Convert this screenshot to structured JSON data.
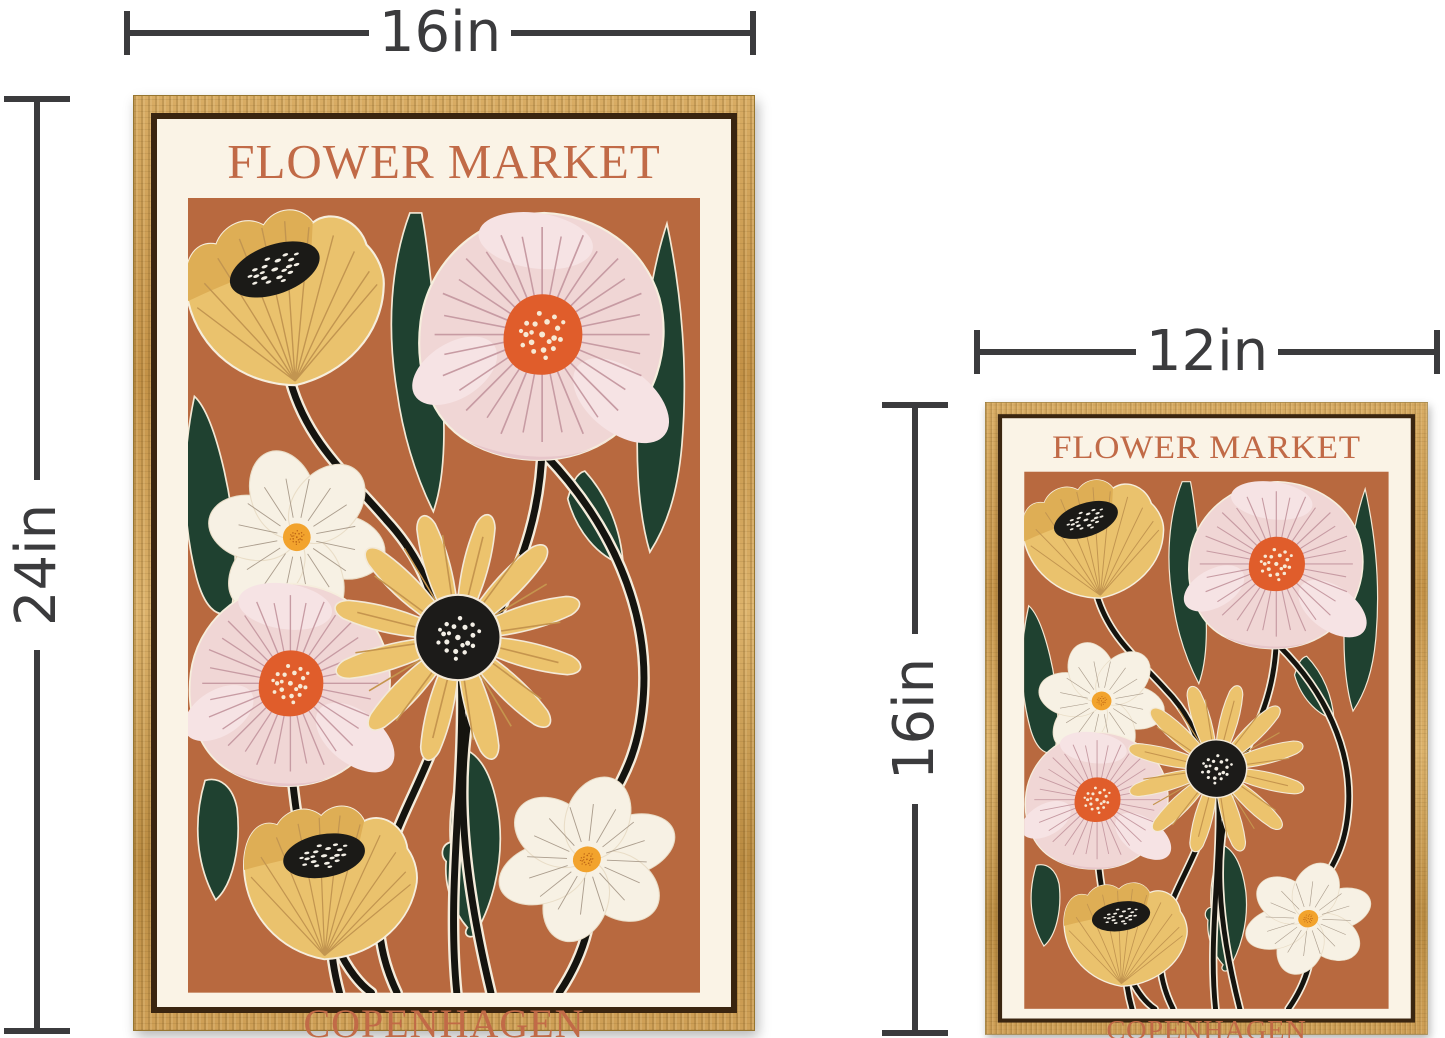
{
  "posters": {
    "artwork": {
      "title": "FLOWER MARKET",
      "city": "COPENHAGEN",
      "collection": "PRINT COLLECTION",
      "series_number": "NO.2",
      "date": "AUGUST 2022"
    },
    "large": {
      "width_label": "16in",
      "height_label": "24in"
    },
    "small": {
      "width_label": "12in",
      "height_label": "16in"
    }
  },
  "colors": {
    "annotation": "#3b3b3d",
    "frame_wood": "#c99c52",
    "paper": "#faf3e6",
    "poster_text": "#c16a47",
    "art_background": "#b8693f",
    "mustard_flower": "#eac26d",
    "pink_flower": "#f0d6d5",
    "orange_center": "#e05d2b",
    "leaf_green": "#1f4130",
    "stem_black": "#15140f"
  }
}
